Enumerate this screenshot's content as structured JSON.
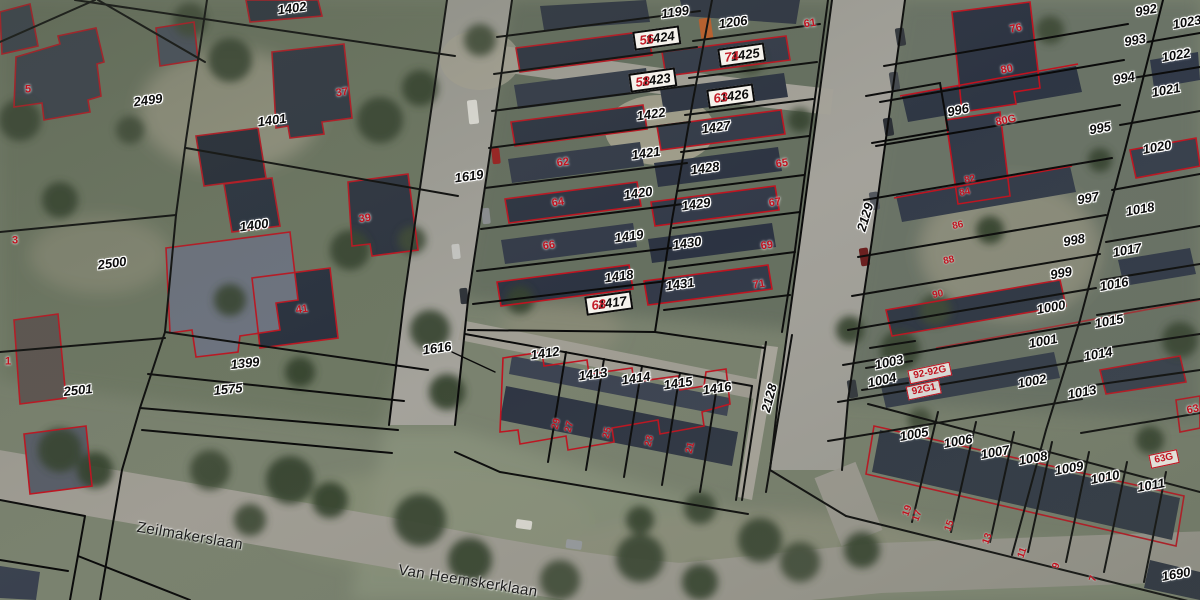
{
  "map": {
    "type": "cadastral-parcel-overlay-on-aerial-photo",
    "colors": {
      "parcel_line": "#0a0a0a",
      "building_outline": "#c1121f",
      "parcel_label_text": "#0b0b0b",
      "house_number_text": "#c1121f",
      "label_halo": "#ffffff"
    },
    "street_names": [
      "Zeilmakerslaan",
      "Van Heemskerklaan"
    ],
    "labels": [
      {
        "t": "1402",
        "x": 292,
        "y": 8,
        "r": -8,
        "k": "p"
      },
      {
        "t": "2499",
        "x": 148,
        "y": 100,
        "r": -8,
        "k": "p"
      },
      {
        "t": "1401",
        "x": 272,
        "y": 120,
        "r": -8,
        "k": "p"
      },
      {
        "t": "1619",
        "x": 469,
        "y": 176,
        "r": -8,
        "k": "p"
      },
      {
        "t": "1400",
        "x": 254,
        "y": 225,
        "r": -8,
        "k": "p"
      },
      {
        "t": "2500",
        "x": 112,
        "y": 263,
        "r": -8,
        "k": "p"
      },
      {
        "t": "1399",
        "x": 245,
        "y": 363,
        "r": -6,
        "k": "p"
      },
      {
        "t": "2501",
        "x": 78,
        "y": 390,
        "r": -6,
        "k": "p"
      },
      {
        "t": "1575",
        "x": 228,
        "y": 389,
        "r": -6,
        "k": "p"
      },
      {
        "t": "1616",
        "x": 437,
        "y": 348,
        "r": -8,
        "k": "p"
      },
      {
        "t": "1199",
        "x": 675,
        "y": 12,
        "r": -8,
        "k": "p"
      },
      {
        "t": "1206",
        "x": 733,
        "y": 22,
        "r": -8,
        "k": "p"
      },
      {
        "t": "1424",
        "x": 657,
        "y": 38,
        "r": -8,
        "k": "pb",
        "pre": "56"
      },
      {
        "t": "1425",
        "x": 742,
        "y": 55,
        "r": -8,
        "k": "pb",
        "pre": "74"
      },
      {
        "t": "1423",
        "x": 653,
        "y": 80,
        "r": -8,
        "k": "pb",
        "pre": "58"
      },
      {
        "t": "1426",
        "x": 731,
        "y": 96,
        "r": -8,
        "k": "pb",
        "pre": "63"
      },
      {
        "t": "1422",
        "x": 651,
        "y": 114,
        "r": -8,
        "k": "p"
      },
      {
        "t": "1427",
        "x": 716,
        "y": 127,
        "r": -8,
        "k": "p"
      },
      {
        "t": "1421",
        "x": 646,
        "y": 153,
        "r": -8,
        "k": "p"
      },
      {
        "t": "1428",
        "x": 705,
        "y": 168,
        "r": -8,
        "k": "p"
      },
      {
        "t": "1420",
        "x": 638,
        "y": 193,
        "r": -8,
        "k": "p"
      },
      {
        "t": "1429",
        "x": 696,
        "y": 204,
        "r": -8,
        "k": "p"
      },
      {
        "t": "1419",
        "x": 629,
        "y": 236,
        "r": -8,
        "k": "p"
      },
      {
        "t": "1430",
        "x": 687,
        "y": 243,
        "r": -8,
        "k": "p"
      },
      {
        "t": "1418",
        "x": 619,
        "y": 276,
        "r": -8,
        "k": "p"
      },
      {
        "t": "1431",
        "x": 680,
        "y": 284,
        "r": -8,
        "k": "p"
      },
      {
        "t": "1417",
        "x": 609,
        "y": 303,
        "r": -8,
        "k": "pb",
        "pre": "68"
      },
      {
        "t": "1412",
        "x": 545,
        "y": 353,
        "r": -8,
        "k": "p"
      },
      {
        "t": "1413",
        "x": 593,
        "y": 374,
        "r": -8,
        "k": "p"
      },
      {
        "t": "1414",
        "x": 636,
        "y": 378,
        "r": -8,
        "k": "p"
      },
      {
        "t": "1415",
        "x": 678,
        "y": 383,
        "r": -8,
        "k": "p"
      },
      {
        "t": "1416",
        "x": 717,
        "y": 388,
        "r": -8,
        "k": "p"
      },
      {
        "t": "2128",
        "x": 769,
        "y": 398,
        "r": -75,
        "k": "p"
      },
      {
        "t": "2129",
        "x": 865,
        "y": 217,
        "r": -73,
        "k": "p"
      },
      {
        "t": "992",
        "x": 1146,
        "y": 10,
        "r": -10,
        "k": "p"
      },
      {
        "t": "1023",
        "x": 1187,
        "y": 22,
        "r": -10,
        "k": "p"
      },
      {
        "t": "993",
        "x": 1135,
        "y": 40,
        "r": -10,
        "k": "p"
      },
      {
        "t": "1022",
        "x": 1176,
        "y": 55,
        "r": -10,
        "k": "p"
      },
      {
        "t": "994",
        "x": 1124,
        "y": 78,
        "r": -10,
        "k": "p"
      },
      {
        "t": "1021",
        "x": 1166,
        "y": 90,
        "r": -10,
        "k": "p"
      },
      {
        "t": "996",
        "x": 958,
        "y": 110,
        "r": -12,
        "k": "p"
      },
      {
        "t": "995",
        "x": 1100,
        "y": 128,
        "r": -10,
        "k": "p"
      },
      {
        "t": "1020",
        "x": 1157,
        "y": 147,
        "r": -10,
        "k": "p"
      },
      {
        "t": "997",
        "x": 1088,
        "y": 198,
        "r": -10,
        "k": "p"
      },
      {
        "t": "1018",
        "x": 1140,
        "y": 209,
        "r": -10,
        "k": "p"
      },
      {
        "t": "998",
        "x": 1074,
        "y": 240,
        "r": -10,
        "k": "p"
      },
      {
        "t": "1017",
        "x": 1127,
        "y": 250,
        "r": -10,
        "k": "p"
      },
      {
        "t": "999",
        "x": 1061,
        "y": 273,
        "r": -10,
        "k": "p"
      },
      {
        "t": "1016",
        "x": 1114,
        "y": 284,
        "r": -10,
        "k": "p"
      },
      {
        "t": "1000",
        "x": 1051,
        "y": 307,
        "r": -10,
        "k": "p"
      },
      {
        "t": "1015",
        "x": 1109,
        "y": 321,
        "r": -10,
        "k": "p"
      },
      {
        "t": "1001",
        "x": 1043,
        "y": 341,
        "r": -10,
        "k": "p"
      },
      {
        "t": "1014",
        "x": 1098,
        "y": 354,
        "r": -10,
        "k": "p"
      },
      {
        "t": "1003",
        "x": 889,
        "y": 362,
        "r": -12,
        "k": "p"
      },
      {
        "t": "1004",
        "x": 882,
        "y": 380,
        "r": -12,
        "k": "p"
      },
      {
        "t": "1002",
        "x": 1032,
        "y": 381,
        "r": -10,
        "k": "p"
      },
      {
        "t": "1013",
        "x": 1082,
        "y": 392,
        "r": -10,
        "k": "p"
      },
      {
        "t": "1005",
        "x": 914,
        "y": 434,
        "r": -10,
        "k": "p"
      },
      {
        "t": "1006",
        "x": 958,
        "y": 441,
        "r": -10,
        "k": "p"
      },
      {
        "t": "1007",
        "x": 995,
        "y": 452,
        "r": -10,
        "k": "p"
      },
      {
        "t": "1008",
        "x": 1033,
        "y": 458,
        "r": -10,
        "k": "p"
      },
      {
        "t": "1009",
        "x": 1069,
        "y": 468,
        "r": -10,
        "k": "p"
      },
      {
        "t": "1010",
        "x": 1105,
        "y": 477,
        "r": -10,
        "k": "p"
      },
      {
        "t": "1011",
        "x": 1151,
        "y": 485,
        "r": -10,
        "k": "p"
      },
      {
        "t": "1690",
        "x": 1176,
        "y": 574,
        "r": -10,
        "k": "p"
      },
      {
        "t": "5",
        "x": 28,
        "y": 90,
        "r": 0,
        "k": "h"
      },
      {
        "t": "3",
        "x": 15,
        "y": 241,
        "r": 0,
        "k": "h"
      },
      {
        "t": "1",
        "x": 8,
        "y": 362,
        "r": 0,
        "k": "h"
      },
      {
        "t": "37",
        "x": 342,
        "y": 93,
        "r": -8,
        "k": "h"
      },
      {
        "t": "39",
        "x": 365,
        "y": 219,
        "r": -8,
        "k": "h"
      },
      {
        "t": "41",
        "x": 302,
        "y": 310,
        "r": -8,
        "k": "h"
      },
      {
        "t": "62",
        "x": 563,
        "y": 163,
        "r": -8,
        "k": "h"
      },
      {
        "t": "64",
        "x": 558,
        "y": 203,
        "r": -8,
        "k": "h"
      },
      {
        "t": "66",
        "x": 549,
        "y": 246,
        "r": -8,
        "k": "h"
      },
      {
        "t": "61",
        "x": 810,
        "y": 24,
        "r": -8,
        "k": "h"
      },
      {
        "t": "65",
        "x": 782,
        "y": 164,
        "r": -8,
        "k": "h"
      },
      {
        "t": "67",
        "x": 775,
        "y": 203,
        "r": -8,
        "k": "h"
      },
      {
        "t": "69",
        "x": 767,
        "y": 246,
        "r": -8,
        "k": "h"
      },
      {
        "t": "71",
        "x": 759,
        "y": 285,
        "r": -8,
        "k": "h"
      },
      {
        "t": "29",
        "x": 557,
        "y": 424,
        "r": -75,
        "k": "hs"
      },
      {
        "t": "27",
        "x": 570,
        "y": 427,
        "r": -75,
        "k": "hs"
      },
      {
        "t": "25",
        "x": 608,
        "y": 433,
        "r": -75,
        "k": "hs"
      },
      {
        "t": "23",
        "x": 650,
        "y": 441,
        "r": -75,
        "k": "hs"
      },
      {
        "t": "21",
        "x": 691,
        "y": 448,
        "r": -75,
        "k": "hs"
      },
      {
        "t": "76",
        "x": 1016,
        "y": 29,
        "r": -12,
        "k": "h"
      },
      {
        "t": "80",
        "x": 1007,
        "y": 70,
        "r": -12,
        "k": "h"
      },
      {
        "t": "80G",
        "x": 1006,
        "y": 121,
        "r": -12,
        "k": "h"
      },
      {
        "t": "82",
        "x": 970,
        "y": 180,
        "r": -12,
        "k": "hs"
      },
      {
        "t": "84",
        "x": 965,
        "y": 193,
        "r": -12,
        "k": "hs"
      },
      {
        "t": "86",
        "x": 958,
        "y": 226,
        "r": -12,
        "k": "hs"
      },
      {
        "t": "88",
        "x": 949,
        "y": 261,
        "r": -12,
        "k": "hs"
      },
      {
        "t": "90",
        "x": 938,
        "y": 295,
        "r": -12,
        "k": "hs"
      },
      {
        "t": "92-92G",
        "x": 930,
        "y": 373,
        "r": -12,
        "k": "hb"
      },
      {
        "t": "92G1",
        "x": 924,
        "y": 390,
        "r": -12,
        "k": "hb"
      },
      {
        "t": "63",
        "x": 1193,
        "y": 410,
        "r": -12,
        "k": "h"
      },
      {
        "t": "63G",
        "x": 1164,
        "y": 459,
        "r": -12,
        "k": "hb"
      },
      {
        "t": "19",
        "x": 908,
        "y": 511,
        "r": -70,
        "k": "hs"
      },
      {
        "t": "17",
        "x": 918,
        "y": 516,
        "r": -70,
        "k": "hs"
      },
      {
        "t": "15",
        "x": 950,
        "y": 526,
        "r": -70,
        "k": "hs"
      },
      {
        "t": "13",
        "x": 988,
        "y": 539,
        "r": -70,
        "k": "hs"
      },
      {
        "t": "11",
        "x": 1023,
        "y": 553,
        "r": -70,
        "k": "hs"
      },
      {
        "t": "9",
        "x": 1057,
        "y": 566,
        "r": -70,
        "k": "hs"
      },
      {
        "t": "7",
        "x": 1094,
        "y": 579,
        "r": -70,
        "k": "hs"
      },
      {
        "t": "Zeilmakerslaan",
        "x": 190,
        "y": 536,
        "r": 9.5,
        "k": "s"
      },
      {
        "t": "Van Heemskerklaan",
        "x": 468,
        "y": 581,
        "r": 9,
        "k": "s"
      }
    ]
  }
}
